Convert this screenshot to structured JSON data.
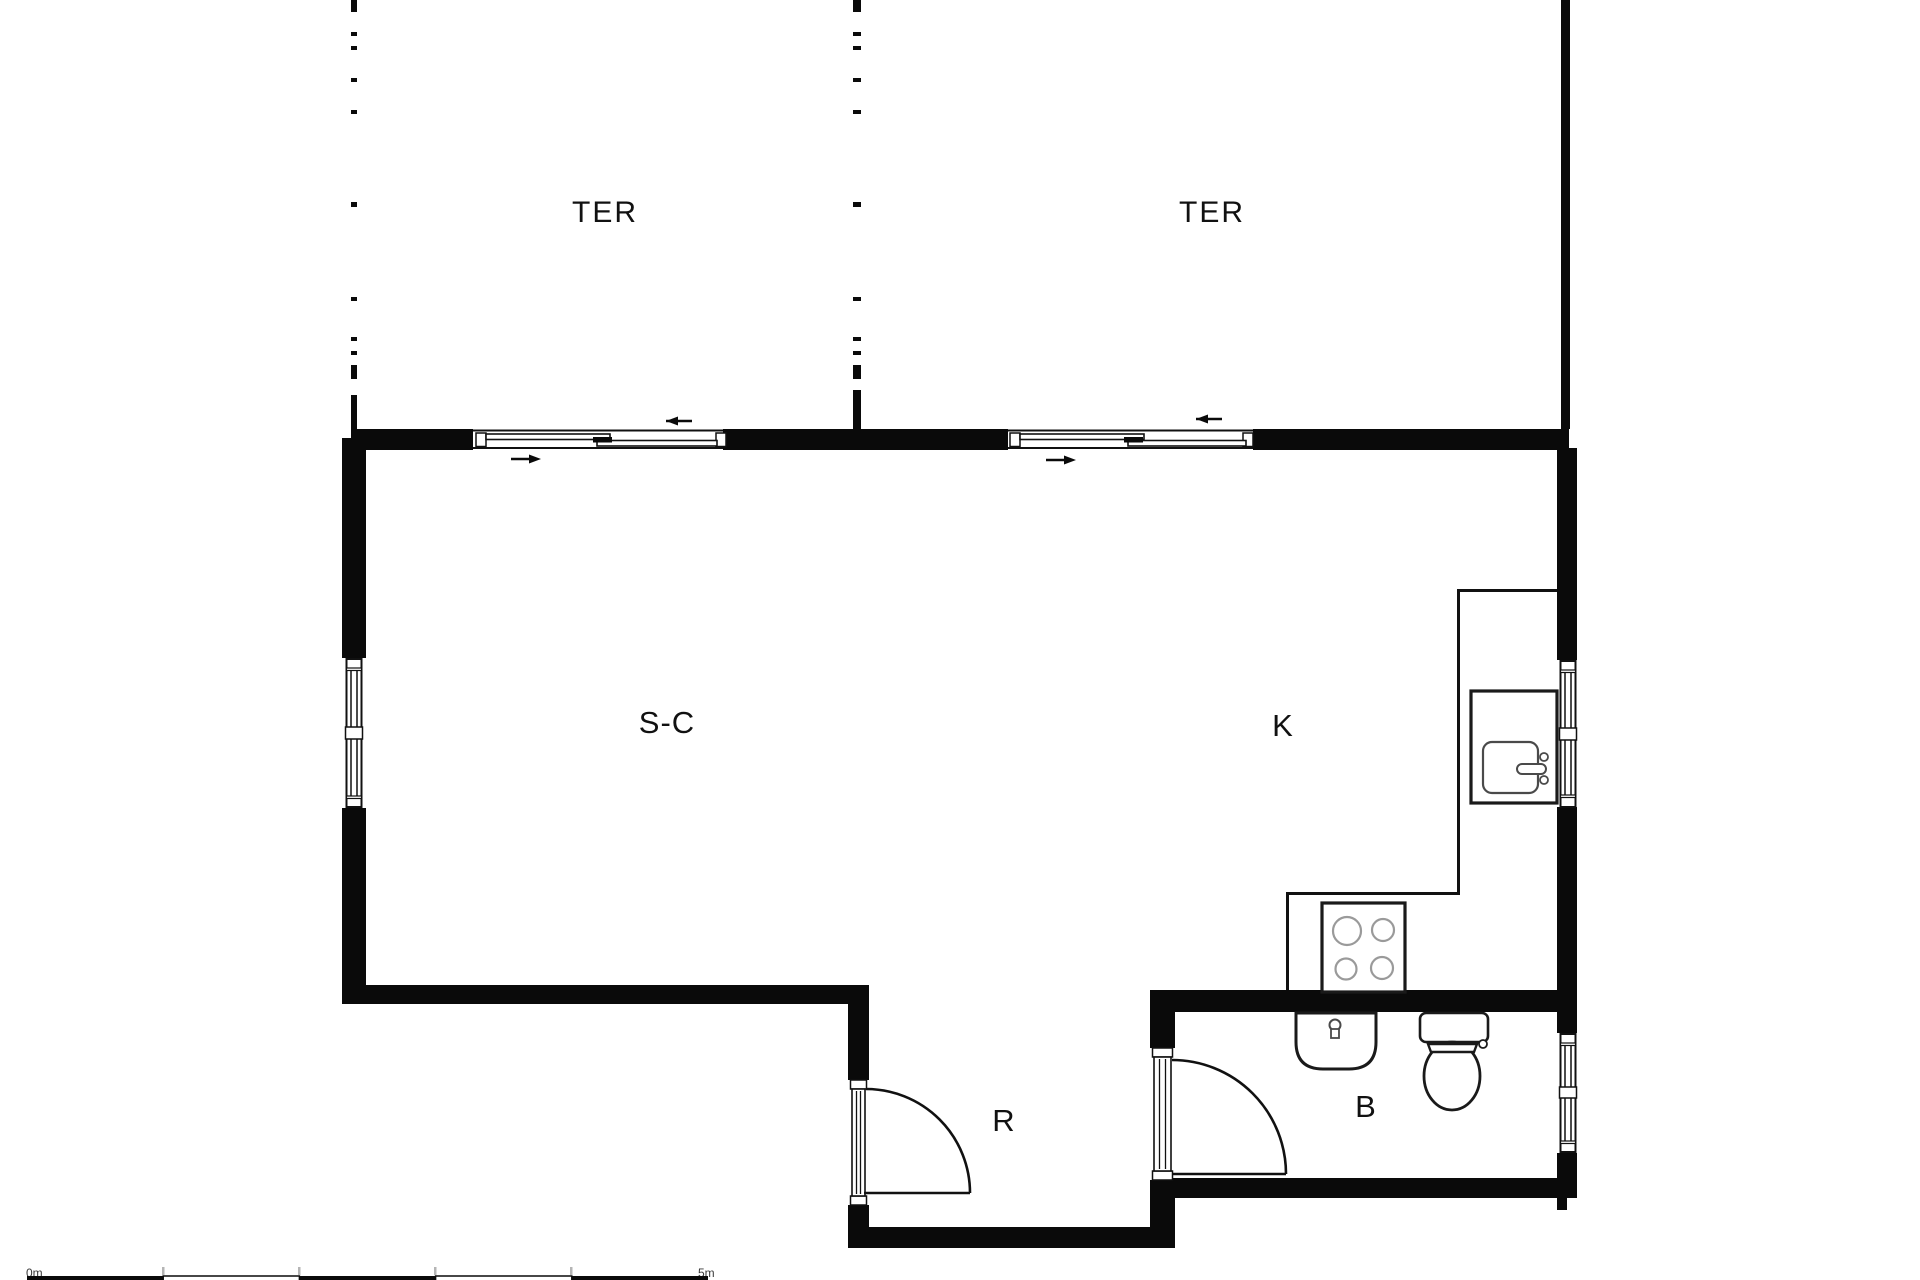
{
  "plan": {
    "title": "studio floor plan",
    "rooms": [
      {
        "id": "terrace-left",
        "label": "TER"
      },
      {
        "id": "terrace-right",
        "label": "TER"
      },
      {
        "id": "living",
        "label": "S-C"
      },
      {
        "id": "kitchen",
        "label": "K"
      },
      {
        "id": "hall",
        "label": "R"
      },
      {
        "id": "bathroom",
        "label": "B"
      }
    ],
    "fixtures": [
      "kitchen-sink",
      "stove-4-burners",
      "kitchen-counter",
      "bathroom-sink",
      "toilet",
      "sliding-door-left",
      "sliding-door-right",
      "hinged-door-hall",
      "hinged-door-bathroom",
      "window-left-wall",
      "window-kitchen",
      "window-bathroom"
    ],
    "scale_bar": {
      "start_label": "0m",
      "end_label": "5m"
    },
    "colors": {
      "wall": "#0a0a0a",
      "line": "#111111",
      "burner_stroke": "#9a9a9a",
      "fixture_stroke": "#1a1a1a",
      "tick": "#b5b5b5",
      "background": "#ffffff"
    }
  }
}
